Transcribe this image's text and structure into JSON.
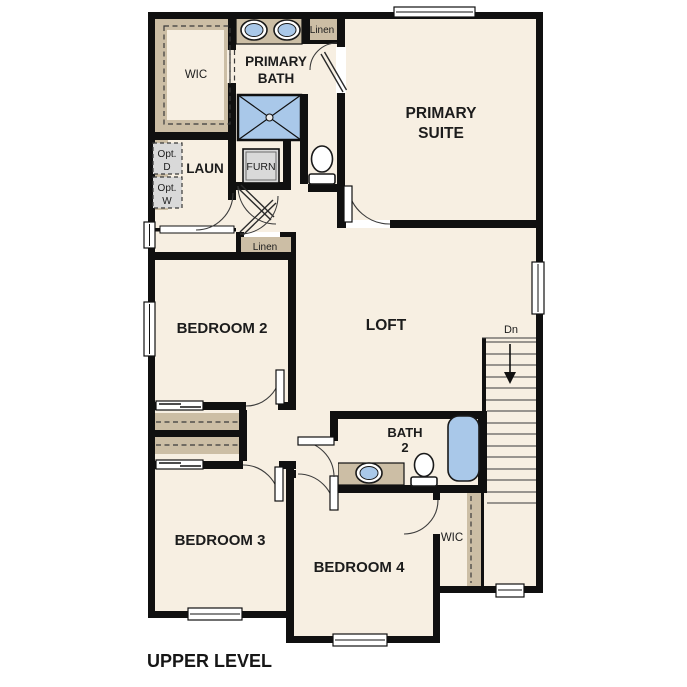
{
  "title": {
    "label": "UPPER LEVEL"
  },
  "rooms": {
    "primary_suite": {
      "line1": "PRIMARY",
      "line2": "SUITE"
    },
    "primary_bath": {
      "line1": "PRIMARY",
      "line2": "BATH"
    },
    "wic_primary": {
      "label": "WIC"
    },
    "laundry": {
      "label": "LAUN"
    },
    "bedroom2": {
      "label": "BEDROOM 2"
    },
    "loft": {
      "label": "LOFT"
    },
    "bath2": {
      "line1": "BATH",
      "line2": "2"
    },
    "bedroom3": {
      "label": "BEDROOM 3"
    },
    "bedroom4": {
      "label": "BEDROOM 4"
    },
    "wic_bedroom4": {
      "label": "WIC"
    }
  },
  "closets": {
    "linen_upper": {
      "label": "Linen"
    },
    "linen_hall": {
      "label": "Linen"
    }
  },
  "equipment": {
    "furnace": {
      "label": "FURN"
    },
    "opt_dryer": {
      "line1": "Opt.",
      "line2": "D"
    },
    "opt_washer": {
      "line1": "Opt.",
      "line2": "W"
    }
  },
  "stairs": {
    "direction_label": "Dn"
  },
  "colors": {
    "floor": "#f7efe2",
    "wall": "#101010",
    "casework_tan": "#ccbea5",
    "fixture_blue": "#a9c8e9",
    "equipment_gray": "#d9d9d9"
  }
}
